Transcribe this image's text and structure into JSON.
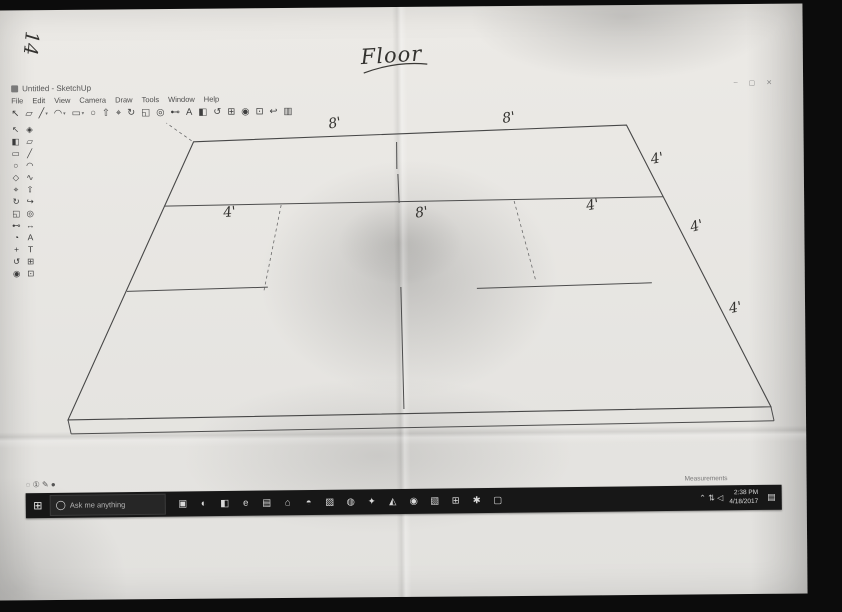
{
  "handwriting": {
    "page_number": "14",
    "sheet_title": "Floor"
  },
  "window": {
    "title": "Untitled - SketchUp",
    "controls": [
      {
        "name": "minimize",
        "glyph": "–"
      },
      {
        "name": "maximize",
        "glyph": "▢"
      },
      {
        "name": "close",
        "glyph": "✕"
      }
    ],
    "menus": [
      "File",
      "Edit",
      "View",
      "Camera",
      "Draw",
      "Tools",
      "Window",
      "Help"
    ]
  },
  "toolbar": {
    "icons": [
      {
        "name": "select-tool-icon",
        "glyph": "↖"
      },
      {
        "name": "eraser-tool-icon",
        "glyph": "▱"
      },
      {
        "name": "line-tool-icon",
        "glyph": "╱",
        "dropdown": true
      },
      {
        "name": "arc-tool-icon",
        "glyph": "◠",
        "dropdown": true
      },
      {
        "name": "rectangle-tool-icon",
        "glyph": "▭",
        "dropdown": true
      },
      {
        "name": "circle-tool-icon",
        "glyph": "○"
      },
      {
        "name": "push-pull-tool-icon",
        "glyph": "⇧"
      },
      {
        "name": "move-tool-icon",
        "glyph": "⌖"
      },
      {
        "name": "rotate-tool-icon",
        "glyph": "↻"
      },
      {
        "name": "scale-tool-icon",
        "glyph": "◱"
      },
      {
        "name": "offset-tool-icon",
        "glyph": "◎"
      },
      {
        "name": "tape-measure-tool-icon",
        "glyph": "⊷"
      },
      {
        "name": "text-tool-icon",
        "glyph": "A"
      },
      {
        "name": "paint-bucket-tool-icon",
        "glyph": "◧"
      },
      {
        "name": "orbit-tool-icon",
        "glyph": "↺"
      },
      {
        "name": "pan-tool-icon",
        "glyph": "⊞"
      },
      {
        "name": "zoom-tool-icon",
        "glyph": "◉"
      },
      {
        "name": "zoom-extents-tool-icon",
        "glyph": "⊡"
      },
      {
        "name": "undo-icon",
        "glyph": "↩"
      },
      {
        "name": "model-info-icon",
        "glyph": "▥"
      }
    ]
  },
  "tool_palette": {
    "icons": [
      {
        "name": "select-tool-icon",
        "glyph": "↖"
      },
      {
        "name": "make-component-icon",
        "glyph": "◈"
      },
      {
        "name": "paint-bucket-icon",
        "glyph": "◧"
      },
      {
        "name": "eraser-icon",
        "glyph": "▱"
      },
      {
        "name": "rectangle-icon",
        "glyph": "▭"
      },
      {
        "name": "line-icon",
        "glyph": "╱"
      },
      {
        "name": "circle-icon",
        "glyph": "○"
      },
      {
        "name": "arc-icon",
        "glyph": "◠"
      },
      {
        "name": "polygon-icon",
        "glyph": "◇"
      },
      {
        "name": "freehand-icon",
        "glyph": "∿"
      },
      {
        "name": "move-icon",
        "glyph": "⌖"
      },
      {
        "name": "push-pull-icon",
        "glyph": "⇧"
      },
      {
        "name": "rotate-icon",
        "glyph": "↻"
      },
      {
        "name": "follow-me-icon",
        "glyph": "↪"
      },
      {
        "name": "scale-icon",
        "glyph": "◱"
      },
      {
        "name": "offset-icon",
        "glyph": "◎"
      },
      {
        "name": "tape-measure-icon",
        "glyph": "⊷"
      },
      {
        "name": "dimension-icon",
        "glyph": "↔"
      },
      {
        "name": "protractor-icon",
        "glyph": "◔"
      },
      {
        "name": "text-icon",
        "glyph": "A"
      },
      {
        "name": "axes-icon",
        "glyph": "+"
      },
      {
        "name": "3d-text-icon",
        "glyph": "T"
      },
      {
        "name": "orbit-icon",
        "glyph": "↺"
      },
      {
        "name": "pan-icon",
        "glyph": "⊞"
      },
      {
        "name": "zoom-icon",
        "glyph": "◉"
      },
      {
        "name": "zoom-extents-icon",
        "glyph": "⊡"
      }
    ]
  },
  "drawing": {
    "outline": [
      [
        185,
        21
      ],
      [
        618,
        8
      ],
      [
        760,
        291
      ],
      [
        57,
        298
      ]
    ],
    "edges": [
      [
        57,
        298,
        60,
        312
      ],
      [
        60,
        312,
        763,
        305
      ],
      [
        763,
        305,
        760,
        291
      ],
      [
        155,
        85,
        654,
        80
      ],
      [
        117,
        170,
        258,
        167
      ],
      [
        467,
        170,
        642,
        166
      ],
      [
        388,
        23,
        388,
        50
      ],
      [
        389,
        55,
        390,
        84
      ],
      [
        391,
        168,
        393,
        290
      ]
    ],
    "dashed": [
      [
        272,
        85,
        254,
        171
      ],
      [
        505,
        83,
        526,
        163
      ],
      [
        183,
        20,
        158,
        2
      ]
    ],
    "annotations": [
      {
        "text": "8'",
        "x": 320,
        "y": -4,
        "rot": -10
      },
      {
        "text": "8'",
        "x": 494,
        "y": -8,
        "rot": -8
      },
      {
        "text": "4'",
        "x": 642,
        "y": 34,
        "rot": -10
      },
      {
        "text": "4'",
        "x": 681,
        "y": 102,
        "rot": -14
      },
      {
        "text": "4'",
        "x": 719,
        "y": 184,
        "rot": -10
      },
      {
        "text": "4'",
        "x": 214,
        "y": 84,
        "rot": -6
      },
      {
        "text": "8'",
        "x": 406,
        "y": 86,
        "rot": -8
      },
      {
        "text": "4'",
        "x": 577,
        "y": 80,
        "rot": -10
      }
    ]
  },
  "status_bar": {
    "icons": [
      {
        "name": "geolocation-icon",
        "glyph": "◌"
      },
      {
        "name": "credits-icon",
        "glyph": "①"
      },
      {
        "name": "claim-credit-icon",
        "glyph": "✎"
      },
      {
        "name": "help-status-icon",
        "glyph": "●"
      }
    ],
    "measurements_label": "Measurements"
  },
  "taskbar": {
    "start": {
      "glyph": "⊞"
    },
    "search": {
      "placeholder": "Ask me anything"
    },
    "apps": [
      {
        "name": "task-view-button",
        "glyph": "▣"
      },
      {
        "name": "taskbar-app-icon-1",
        "glyph": "◐"
      },
      {
        "name": "taskbar-app-icon-2",
        "glyph": "◧"
      },
      {
        "name": "edge-icon",
        "glyph": "e"
      },
      {
        "name": "file-explorer-icon",
        "glyph": "▤"
      },
      {
        "name": "store-icon",
        "glyph": "⌂"
      },
      {
        "name": "taskbar-app-icon-3",
        "glyph": "◓"
      },
      {
        "name": "photos-icon",
        "glyph": "▨"
      },
      {
        "name": "chrome-icon",
        "glyph": "◍"
      },
      {
        "name": "taskbar-app-icon-4",
        "glyph": "✦"
      },
      {
        "name": "sketchup-icon",
        "glyph": "◭"
      },
      {
        "name": "taskbar-app-icon-5",
        "glyph": "◉"
      },
      {
        "name": "taskbar-app-icon-6",
        "glyph": "▧"
      },
      {
        "name": "grid-app-icon",
        "glyph": "⊞"
      },
      {
        "name": "settings-icon",
        "glyph": "✱"
      },
      {
        "name": "monitor-app-icon",
        "glyph": "▢"
      }
    ],
    "tray": {
      "icons": [
        {
          "name": "tray-expand-icon",
          "glyph": "⌃"
        },
        {
          "name": "network-icon",
          "glyph": "⇅"
        },
        {
          "name": "volume-icon",
          "glyph": "◁"
        }
      ],
      "time": "2:38 PM",
      "date": "4/18/2017",
      "action_center_glyph": "▤"
    }
  }
}
